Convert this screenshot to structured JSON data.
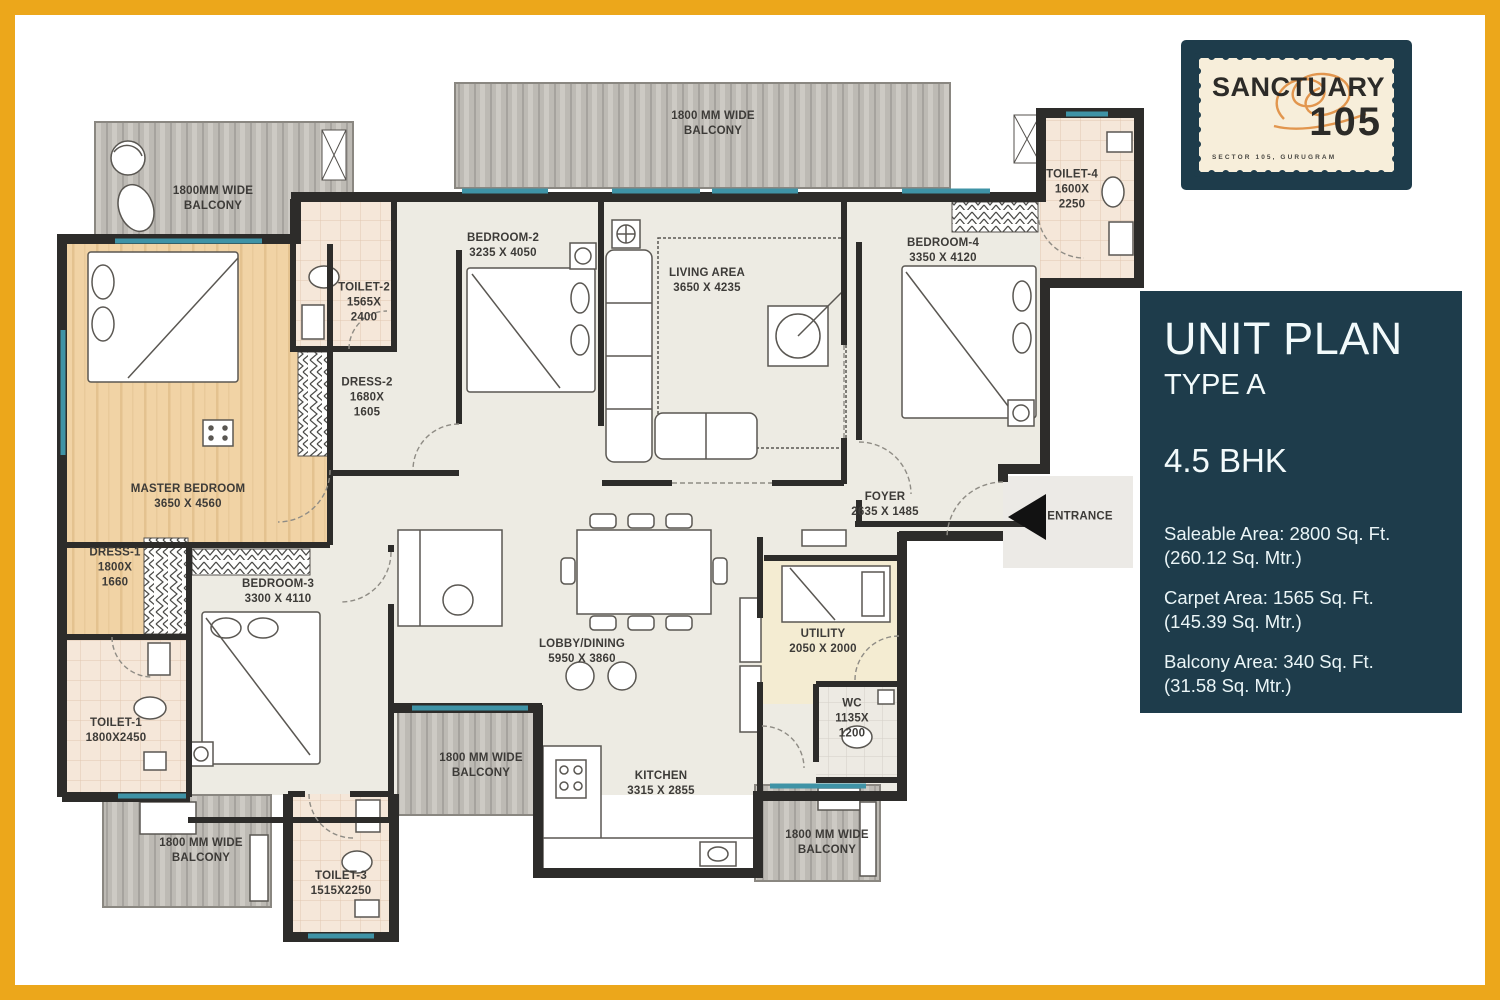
{
  "colors": {
    "frame_gold": "#ECA71B",
    "panel_teal": "#1E3C4B",
    "stamp_cream": "#F7EEDA",
    "scribble_orange": "#DF8C3E",
    "wall_dark": "#2D2C2A",
    "window_teal": "#3F93A6",
    "master_floor_tan": "#F1D3A5",
    "balcony_gray": "#BDBAB4"
  },
  "logo": {
    "name": "SANCTUARY",
    "number": "105",
    "tagline": "SECTOR 105, GURUGRAM"
  },
  "panel": {
    "title": "UNIT PLAN",
    "type": "TYPE A",
    "bhk": "4.5 BHK",
    "areas": [
      "Saleable Area: 2800 Sq. Ft.\n(260.12 Sq. Mtr.)",
      "Carpet Area: 1565 Sq. Ft.\n(145.39 Sq. Mtr.)",
      "Balcony Area: 340 Sq. Ft.\n(31.58 Sq. Mtr.)"
    ]
  },
  "plan": {
    "labels": [
      {
        "id": "balcony-top-left",
        "text": "1800MM WIDE\nBALCONY"
      },
      {
        "id": "balcony-top",
        "text": "1800 MM WIDE\nBALCONY"
      },
      {
        "id": "toilet-2",
        "text": "TOILET-2\n1565X\n2400"
      },
      {
        "id": "bedroom-2",
        "text": "BEDROOM-2\n3235 X 4050"
      },
      {
        "id": "living-area",
        "text": "LIVING AREA\n3650 X 4235"
      },
      {
        "id": "bedroom-4",
        "text": "BEDROOM-4\n3350 X 4120"
      },
      {
        "id": "toilet-4",
        "text": "TOILET-4\n1600X\n2250"
      },
      {
        "id": "master-bedroom",
        "text": "MASTER BEDROOM\n3650 X 4560"
      },
      {
        "id": "dress-2",
        "text": "DRESS-2\n1680X\n1605"
      },
      {
        "id": "dress-1",
        "text": "DRESS-1\n1800X\n1660"
      },
      {
        "id": "bedroom-3",
        "text": "BEDROOM-3\n3300 X 4110"
      },
      {
        "id": "foyer",
        "text": "FOYER\n2635 X 1485"
      },
      {
        "id": "entrance",
        "text": "ENTRANCE"
      },
      {
        "id": "toilet-1",
        "text": "TOILET-1\n1800X2450"
      },
      {
        "id": "lobby-dining",
        "text": "LOBBY/DINING\n5950 X 3860"
      },
      {
        "id": "utility",
        "text": "UTILITY\n2050 X 2000"
      },
      {
        "id": "wc",
        "text": "WC\n1135X\n1200"
      },
      {
        "id": "kitchen",
        "text": "KITCHEN\n3315 X 2855"
      },
      {
        "id": "balcony-mid",
        "text": "1800 MM WIDE\nBALCONY"
      },
      {
        "id": "balcony-bottom-left",
        "text": "1800 MM WIDE\nBALCONY"
      },
      {
        "id": "toilet-3",
        "text": "TOILET-3\n1515X2250"
      },
      {
        "id": "balcony-bottom-right",
        "text": "1800 MM WIDE\nBALCONY"
      }
    ]
  }
}
